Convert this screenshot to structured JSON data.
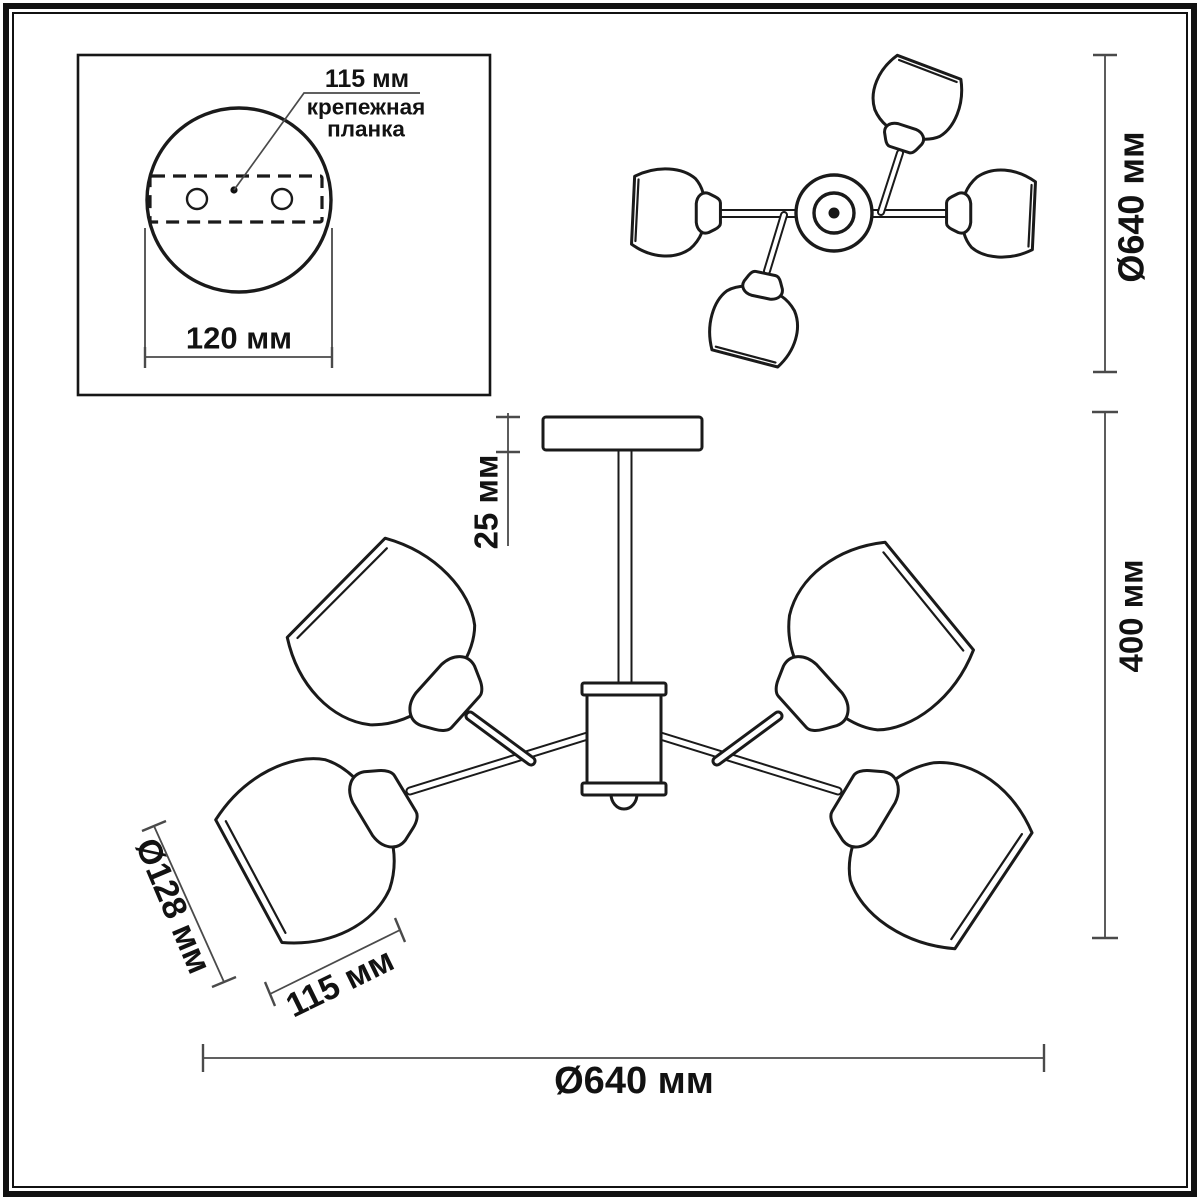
{
  "drawing": {
    "type": "ceiling-chandelier dimensional drawing",
    "colors": {
      "line": "#1a1a1a",
      "dimension_line": "#4a4a4a",
      "background": "#ffffff"
    },
    "labels": {
      "inset_hole_spacing": "115 мм",
      "inset_mount_line1": "крепежная",
      "inset_mount_line2": "планка",
      "inset_canopy_width": "120 мм",
      "top_view_diameter": "Ø640 мм",
      "canopy_height": "25 мм",
      "fixture_height": "400 мм",
      "shade_diameter": "Ø128 мм",
      "shade_width": "115 мм",
      "fixture_diameter": "Ø640 мм"
    },
    "dimensions_mm": {
      "mount_bracket_hole_spacing": 115,
      "canopy_plate_width": 120,
      "fixture_diameter": 640,
      "canopy_height": 25,
      "fixture_height": 400,
      "shade_diameter": 128,
      "shade_width": 115
    }
  }
}
